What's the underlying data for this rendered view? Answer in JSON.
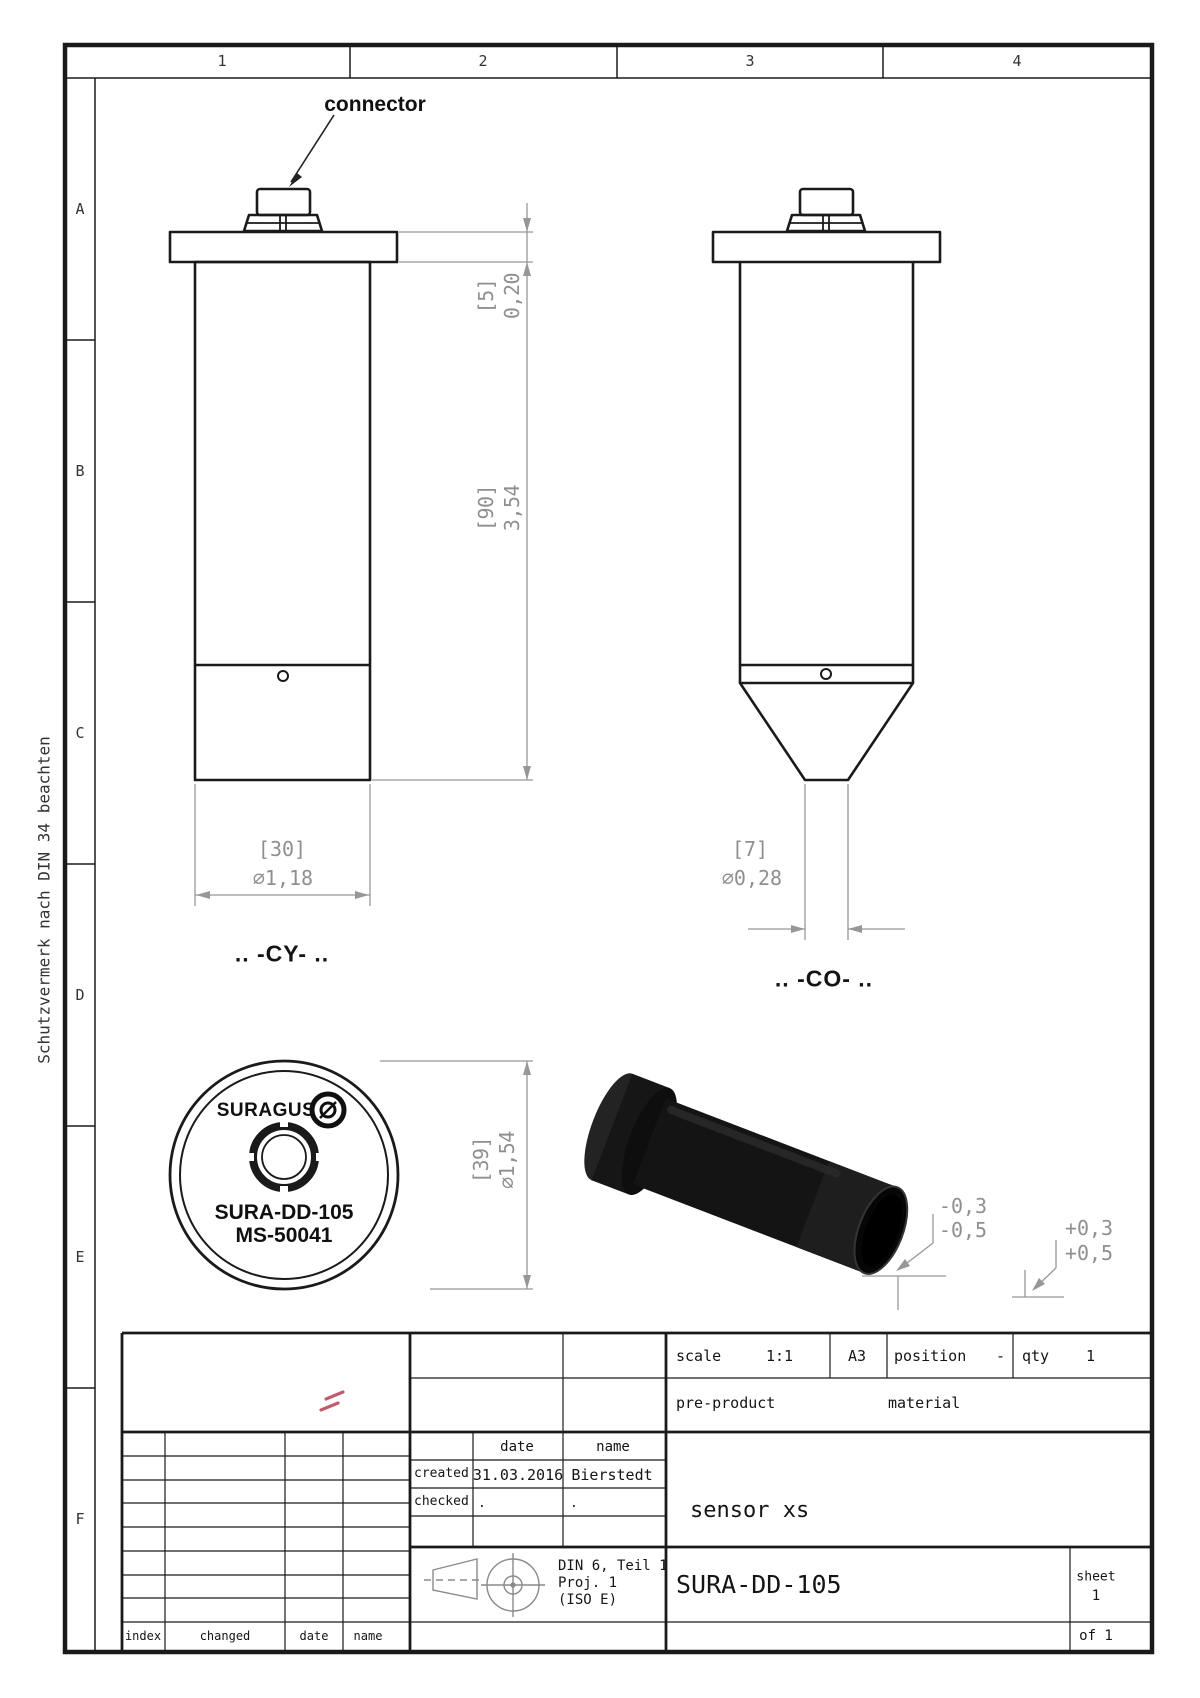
{
  "sheet": {
    "side_note": "Schutzvermerk nach DIN 34 beachten",
    "cols": [
      "1",
      "2",
      "3",
      "4"
    ],
    "rows": [
      "A",
      "B",
      "C",
      "D",
      "E",
      "F"
    ]
  },
  "drawing": {
    "connector_label": "connector",
    "cy_label": ".. -CY- ..",
    "co_label": ".. -CO- ..",
    "dim_flange": {
      "bracket": "[5]",
      "value": "0,20"
    },
    "dim_length": {
      "bracket": "[90]",
      "value": "3,54"
    },
    "dim_body_dia": {
      "bracket": "[30]",
      "value": "⌀1,18"
    },
    "dim_tip_dia": {
      "bracket": "[7]",
      "value": "⌀0,28"
    },
    "dim_face_dia": {
      "bracket": "[39]",
      "value": "⌀1,54"
    },
    "face": {
      "brand": "SURAGUS",
      "model": "SURA-DD-105",
      "serial": "MS-50041"
    },
    "tol_minus_1": "-0,3",
    "tol_minus_2": "-0,5",
    "tol_plus_1": "+0,3",
    "tol_plus_2": "+0,5"
  },
  "titleblock": {
    "scale_label": "scale",
    "scale_value": "1:1",
    "format": "A3",
    "position_label": "position",
    "position_value": "-",
    "qty_label": "qty",
    "qty_value": "1",
    "preproduct_label": "pre-product",
    "material_label": "material",
    "date_header": "date",
    "name_header": "name",
    "created_label": "created",
    "created_date": "31.03.2016",
    "created_name": "Bierstedt",
    "checked_label": "checked",
    "checked_date": ".",
    "checked_name": ".",
    "din_line1": "DIN 6, Teil 1",
    "din_line2": "Proj. 1",
    "din_line3": "(ISO E)",
    "part_name": "sensor xs",
    "part_number": "SURA-DD-105",
    "sheet_label": "sheet",
    "sheet_number": "1",
    "of_label": "of 1",
    "rev_index": "index",
    "rev_changed": "changed",
    "rev_date": "date",
    "rev_name": "name"
  }
}
